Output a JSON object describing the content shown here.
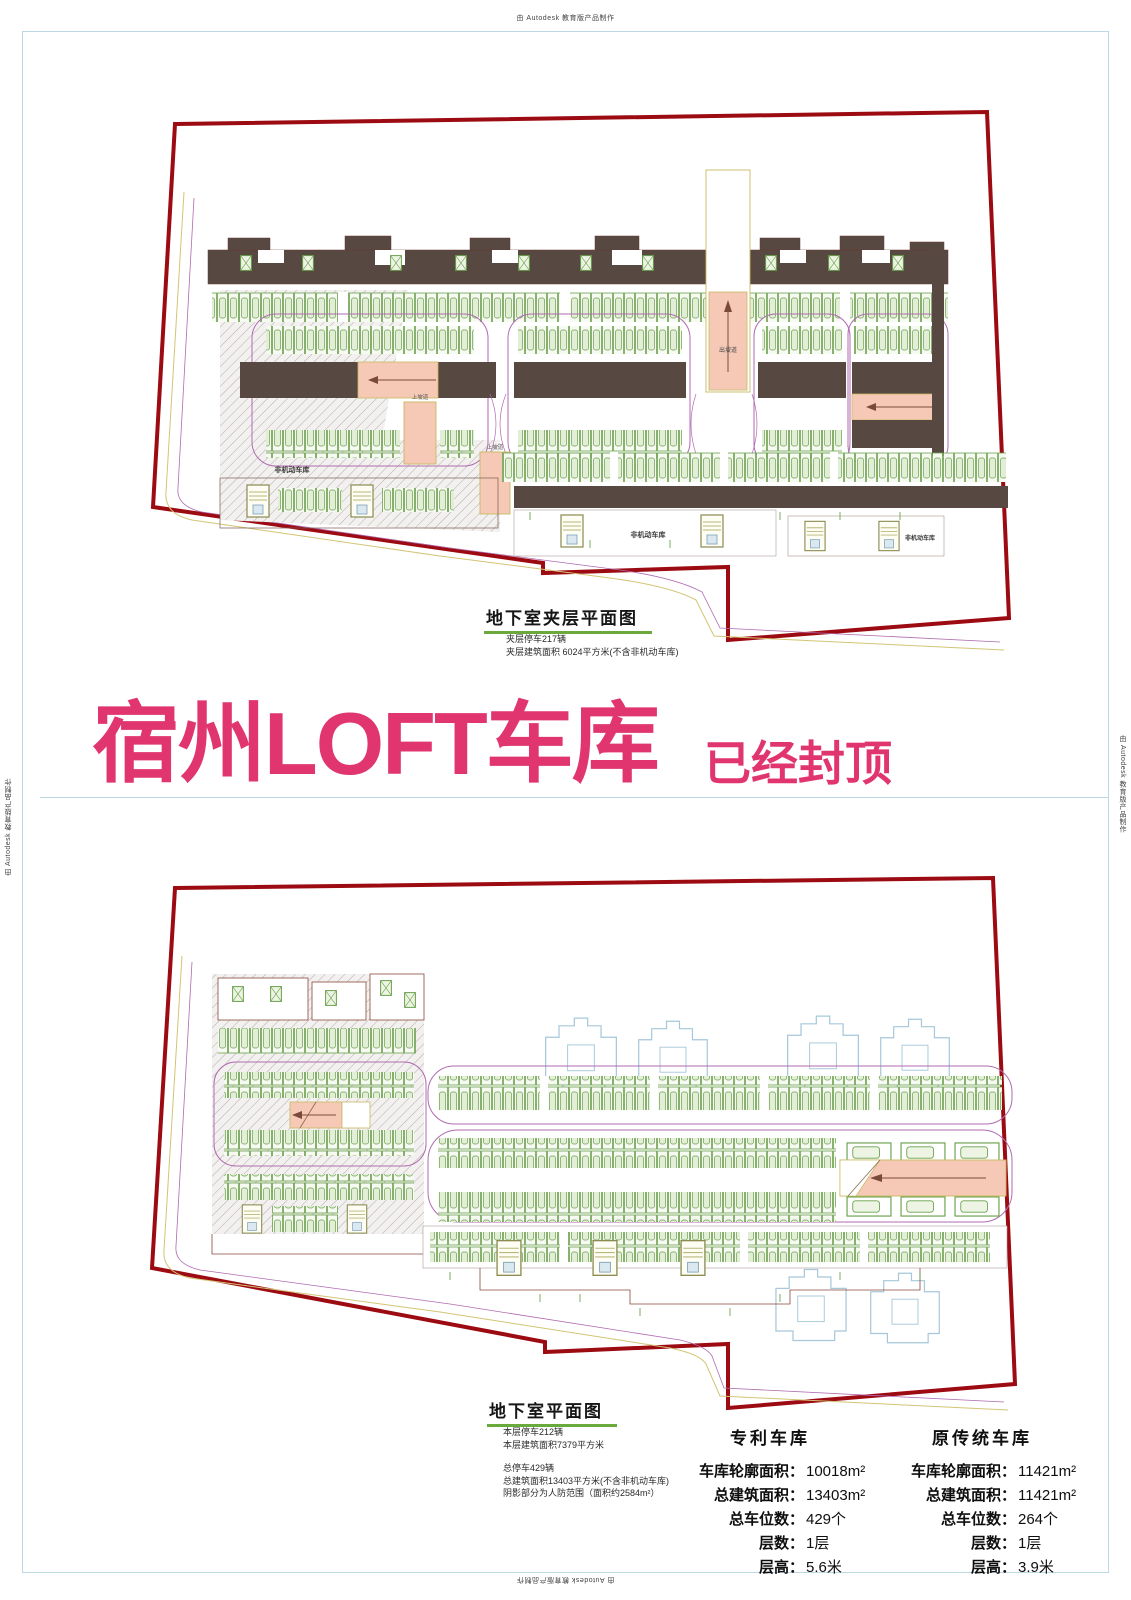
{
  "page": {
    "autodesk_credit": "由 Autodesk 教育版产品制作"
  },
  "sheet1": {
    "title": "地下室夹层平面图",
    "notes": [
      "夹层停车217辆",
      "夹层建筑面积 6024平方米(不含非机动车库)"
    ],
    "plan_labels": {
      "non_motor_garage": "非机动车库",
      "ramp_up": "上坡道",
      "ramp_exit": "出坡道"
    }
  },
  "banner": {
    "title": "宿州LOFT车库",
    "status": "已经封顶"
  },
  "sheet2": {
    "title": "地下室平面图",
    "notes": [
      "本层停车212辆",
      "本层建筑面积7379平方米"
    ],
    "summary_notes": [
      "总停车429辆",
      "总建筑面积13403平方米(不含非机动车库)",
      "阴影部分为人防范围（面积约2584m²）"
    ]
  },
  "comparison": {
    "patent": {
      "title": "专利车库",
      "rows": [
        {
          "label": "车库轮廓面积：",
          "value": "10018m²"
        },
        {
          "label": "总建筑面积：",
          "value": "13403m²"
        },
        {
          "label": "总车位数：",
          "value": "429个"
        },
        {
          "label": "层数：",
          "value": "1层"
        },
        {
          "label": "层高：",
          "value": "5.6米"
        }
      ]
    },
    "traditional": {
      "title": "原传统车库",
      "rows": [
        {
          "label": "车库轮廓面积：",
          "value": "11421m²"
        },
        {
          "label": "总建筑面积：",
          "value": "11421m²"
        },
        {
          "label": "总车位数：",
          "value": "264个"
        },
        {
          "label": "层数：",
          "value": "1层"
        },
        {
          "label": "层高：",
          "value": "3.9米"
        }
      ]
    }
  },
  "colors": {
    "boundary_red": "#9c0a12",
    "accent_pink": "#e0356f",
    "stall_green": "#69a04b",
    "aisle_brown": "#584842",
    "ramp_pink": "#f5c9b6",
    "lane_purple": "#b06ab0",
    "site_yellow": "#d2c474",
    "frame_blue": "#bcd8e4",
    "hatch_gray": "#b5adad",
    "tower_blue": "#a6c8da"
  }
}
